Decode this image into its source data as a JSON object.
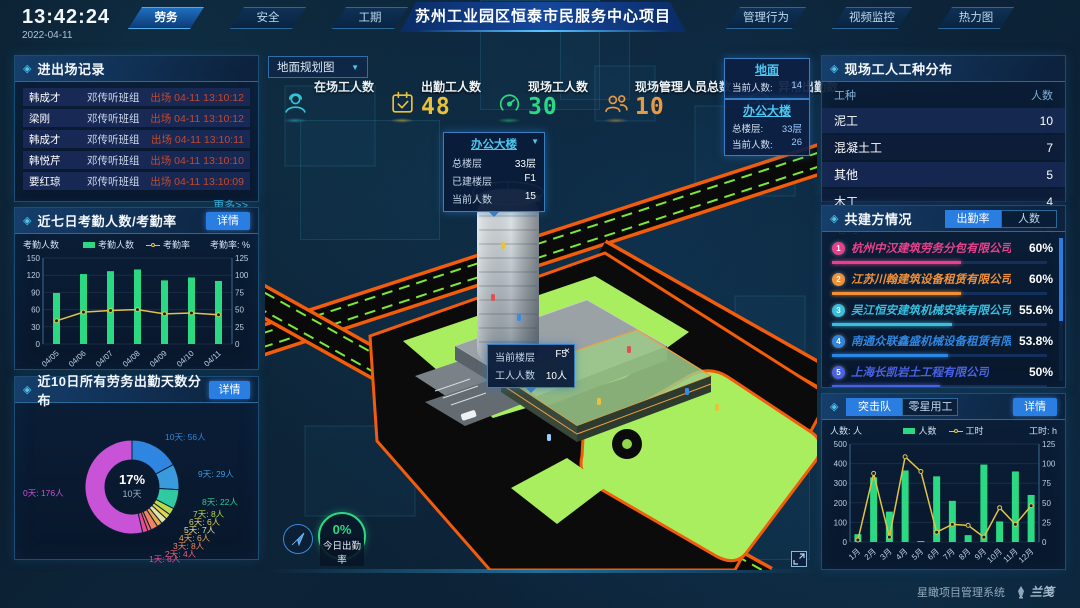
{
  "header": {
    "time": "13:42:24",
    "date": "2022-04-11",
    "title": "苏州工业园区恒泰市民服务中心项目",
    "left_tabs": [
      "劳务",
      "安全",
      "工期"
    ],
    "active_left_tab": "劳务",
    "right_tabs": [
      "管理行为",
      "视频监控",
      "热力图"
    ]
  },
  "panels": {
    "entry_exit": {
      "title": "进出场记录",
      "more_link": "更多>>",
      "rows": [
        {
          "name": "韩成才",
          "team": "邓传听班组",
          "event": "出场 04-11 13:10:12"
        },
        {
          "name": "梁刚",
          "team": "邓传听班组",
          "event": "出场 04-11 13:10:12"
        },
        {
          "name": "韩成才",
          "team": "邓传听班组",
          "event": "出场 04-11 13:10:11"
        },
        {
          "name": "韩悦芹",
          "team": "邓传听班组",
          "event": "出场 04-11 13:10:10"
        },
        {
          "name": "要红琼",
          "team": "邓传听班组",
          "event": "出场 04-11 13:10:09"
        }
      ]
    },
    "attendance_week": {
      "title": "近七日考勤人数/考勤率",
      "detail_label": "详情"
    },
    "attendance_distribution": {
      "title": "近10日所有劳务出勤天数分布",
      "detail_label": "详情"
    },
    "worker_types": {
      "title": "现场工人工种分布",
      "columns": [
        "工种",
        "人数"
      ],
      "rows": [
        [
          "泥工",
          "10"
        ],
        [
          "混凝土工",
          "7"
        ],
        [
          "其他",
          "5"
        ],
        [
          "木工",
          "4"
        ],
        [
          "塔司",
          "4"
        ]
      ]
    },
    "partners": {
      "title": "共建方情况",
      "tabs": [
        "出勤率",
        "人数"
      ],
      "active_tab": "出勤率",
      "rows": [
        {
          "rank": "1",
          "name": "杭州中汉建筑劳务分包有限公司",
          "value": "60%",
          "pct": 60,
          "color": "#e8418c"
        },
        {
          "rank": "2",
          "name": "江苏川翰建筑设备租赁有限公司",
          "value": "60%",
          "pct": 60,
          "color": "#f09038"
        },
        {
          "rank": "3",
          "name": "吴江恒安建筑机械安装有限公司",
          "value": "55.6%",
          "pct": 55.6,
          "color": "#38bede"
        },
        {
          "rank": "4",
          "name": "南通众联鑫盛机械设备租赁有限公司",
          "value": "53.8%",
          "pct": 53.8,
          "color": "#2f86e0"
        },
        {
          "rank": "5",
          "name": "上海长凯岩土工程有限公司",
          "value": "50%",
          "pct": 50,
          "color": "#4a62e6"
        },
        {
          "rank": "6",
          "name": "江苏洁诒建筑安装工程有限公司",
          "value": "35.4%",
          "pct": 35.4,
          "color": "#8a4ad8"
        }
      ]
    },
    "squad": {
      "tabs": [
        "突击队",
        "零星用工"
      ],
      "active_tab": "突击队",
      "detail_label": "详情"
    }
  },
  "map": {
    "layer_select": "地面规划图",
    "stats": [
      {
        "label": "在场工人数",
        "value": "",
        "icon": "worker-icon",
        "color": "#35c8d8"
      },
      {
        "label": "出勤工人数",
        "value": "48",
        "icon": "calendar-check-icon",
        "color": "#e8c23a"
      },
      {
        "label": "现场工人数",
        "value": "30",
        "icon": "gauge-icon",
        "color": "#2bd982"
      },
      {
        "label": "现场管理人员总数",
        "value": "10",
        "icon": "people-icon",
        "color": "#f09a3e"
      },
      {
        "label": "异常出勤数",
        "value": "0",
        "icon": "pulse-icon",
        "color": "#3aa8f0"
      }
    ],
    "building_tooltip": {
      "title": "办公大楼",
      "rows": [
        [
          "总楼层",
          "33层"
        ],
        [
          "已建楼层",
          "F1"
        ],
        [
          "当前人数",
          "15"
        ]
      ]
    },
    "floor_tooltip": {
      "rows": [
        [
          "当前楼层",
          "F5"
        ],
        [
          "工人人数",
          "10人"
        ]
      ],
      "close": "×"
    },
    "side_cards": [
      {
        "title": "地面",
        "rows": [
          [
            "当前人数:",
            "14"
          ]
        ]
      },
      {
        "title": "办公大楼",
        "rows": [
          [
            "总楼层:",
            "33层"
          ],
          [
            "当前人数:",
            "26"
          ]
        ]
      }
    ],
    "today_rate": {
      "value": "0%",
      "label": "今日出勤率"
    }
  },
  "footer": {
    "system_name": "星瞰项目管理系统",
    "logo_text": "兰笺"
  },
  "chart_data": [
    {
      "id": "attendance_week",
      "type": "bar+line",
      "title": "近七日考勤人数/考勤率",
      "categories": [
        "04/05",
        "04/06",
        "04/07",
        "04/08",
        "04/09",
        "04/10",
        "04/11"
      ],
      "series": [
        {
          "name": "考勤人数",
          "kind": "bar",
          "axis": "left",
          "color": "#2bd982",
          "values": [
            89,
            122,
            127,
            130,
            111,
            116,
            110
          ]
        },
        {
          "name": "考勤率",
          "kind": "line",
          "axis": "right",
          "color": "#e3c245",
          "values": [
            27,
            37,
            39,
            40,
            35,
            36,
            34
          ]
        }
      ],
      "left_axis": {
        "label": "考勤人数",
        "min": 0,
        "max": 150,
        "step": 30
      },
      "right_axis": {
        "label": "考勤率: %",
        "min": 0,
        "max": 100,
        "step": 25
      },
      "legend_position": "top",
      "grid": true
    },
    {
      "id": "attendance_distribution",
      "type": "pie",
      "title": "近10日所有劳务出勤天数分布",
      "center": {
        "pct": "17%",
        "label": "10天"
      },
      "slices": [
        {
          "label": "10天",
          "people": 56,
          "text": "10天: 56人",
          "color": "#2f86e0"
        },
        {
          "label": "9天",
          "people": 29,
          "text": "9天: 29人",
          "color": "#3a9ade"
        },
        {
          "label": "8天",
          "people": 22,
          "text": "8天: 22人",
          "color": "#2fc9a2"
        },
        {
          "label": "7天",
          "people": 8,
          "text": "7天: 8人",
          "color": "#b6dc4c"
        },
        {
          "label": "6天",
          "people": 6,
          "text": "6天: 6人",
          "color": "#e6d24e"
        },
        {
          "label": "5天",
          "people": 7,
          "text": "5天: 7人",
          "color": "#dde6a6"
        },
        {
          "label": "4天",
          "people": 6,
          "text": "4天: 6人",
          "color": "#eda94e"
        },
        {
          "label": "3天",
          "people": 8,
          "text": "3天: 8人",
          "color": "#ef8560"
        },
        {
          "label": "2天",
          "people": 4,
          "text": "2天: 4人",
          "color": "#ee6277"
        },
        {
          "label": "1天",
          "people": 6,
          "text": "1天: 6人",
          "color": "#e74b8e"
        },
        {
          "label": "0天",
          "people": 176,
          "text": "0天: 176人",
          "color": "#c853d6"
        }
      ]
    },
    {
      "id": "squad_monthly",
      "type": "bar+line",
      "title": "突击队",
      "categories": [
        "1月",
        "2月",
        "3月",
        "4月",
        "5月",
        "6月",
        "7月",
        "8月",
        "9月",
        "10月",
        "11月",
        "12月"
      ],
      "series": [
        {
          "name": "人数",
          "kind": "bar",
          "axis": "left",
          "color": "#2bd982",
          "values": [
            40,
            330,
            155,
            365,
            5,
            335,
            210,
            35,
            395,
            105,
            360,
            240
          ]
        },
        {
          "name": "工时",
          "kind": "line",
          "axis": "right",
          "color": "#e3c245",
          "values": [
            2,
            70,
            5,
            87,
            72,
            10,
            18,
            17,
            5,
            35,
            18,
            37
          ]
        }
      ],
      "left_axis": {
        "label": "人数: 人",
        "min": 0,
        "max": 500,
        "step": 100
      },
      "right_axis": {
        "label": "工时: h",
        "min": 0,
        "max": 100,
        "step": 25
      },
      "legend_position": "top",
      "grid": true
    }
  ]
}
